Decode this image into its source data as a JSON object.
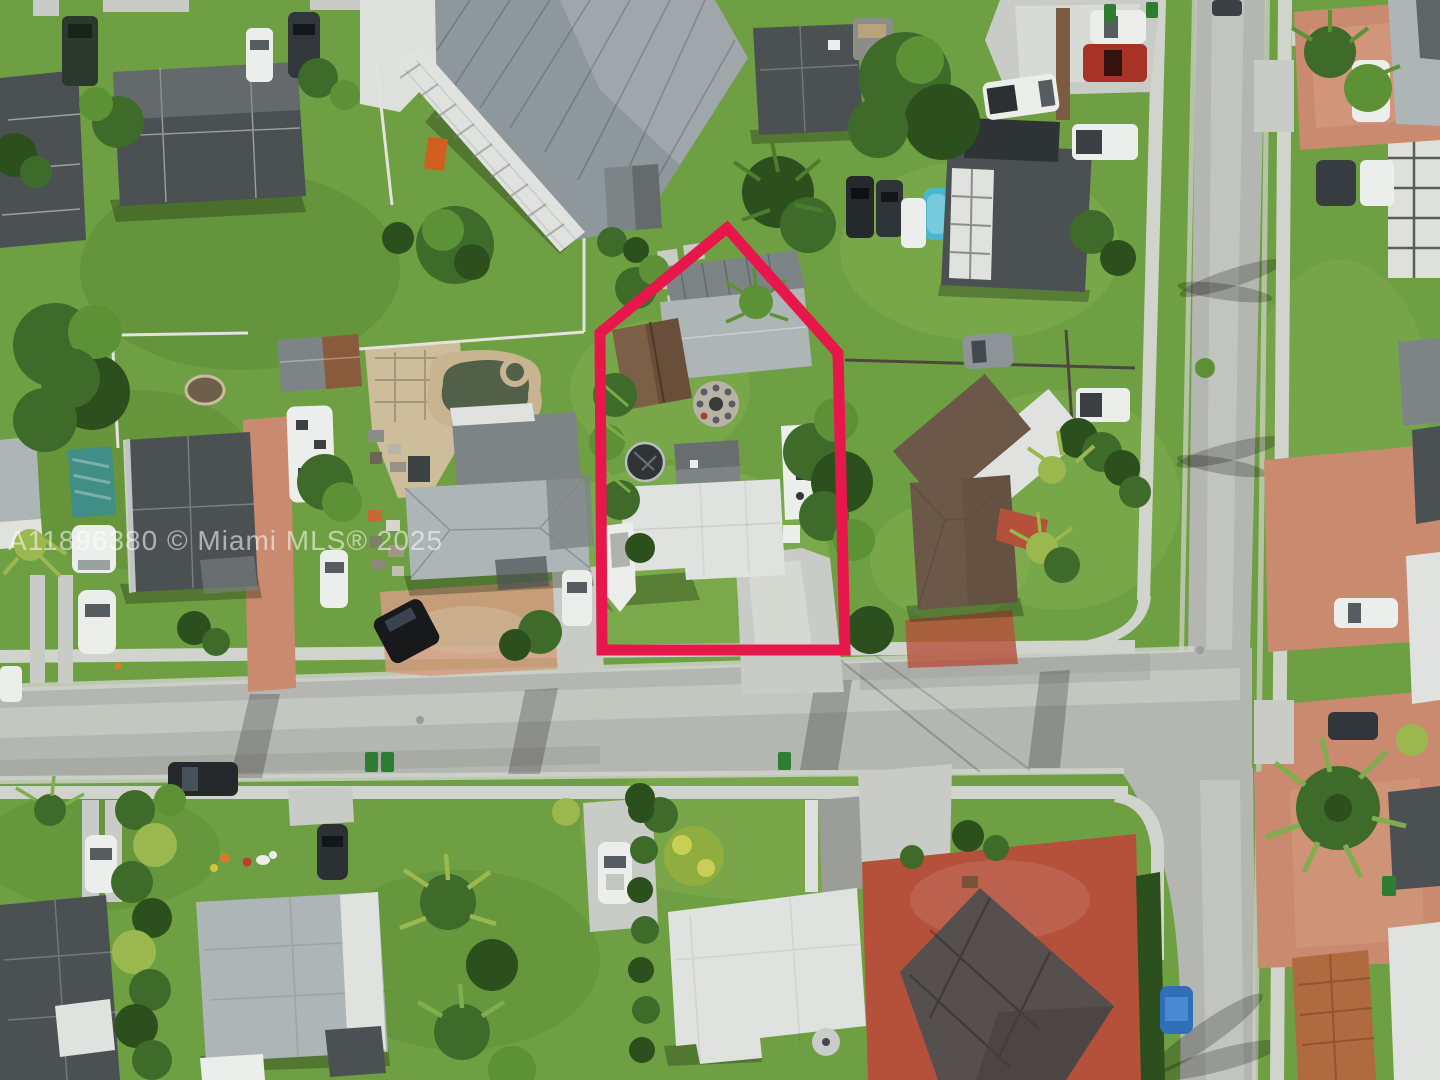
{
  "scene": {
    "description": "Aerial drone photo of a suburban residential neighborhood with a property highlighted by a red boundary outline",
    "subject_property": "house with white roof, carport, brown-roof section, fire pit, RV, boat and driveway inside red outline",
    "roads": "T-intersection: street running west-east meeting a north-south street on the right side"
  },
  "watermark": {
    "text": "A11896380 © Miami MLS® 2025",
    "color": "#ffffff",
    "opacity": 0.55
  },
  "property_outline": {
    "points": "727,228 838,353 845,650 602,650 600,333",
    "color": "#e8174b",
    "stroke_width": 11
  },
  "palette": {
    "grass": "#6f9f43",
    "grass_light": "#82b052",
    "grass_dark": "#558530",
    "road": "#b4b7b1",
    "road_worn": "#c7cac4",
    "road_dark": "#9b9e98",
    "sidewalk": "#d1d4cd",
    "concrete": "#c9ccc6",
    "concrete_bright": "#dee1db",
    "paver": "#c98a6f",
    "paver_light": "#d69c82",
    "court": "#b5503a",
    "roof_dark": "#4b5153",
    "roof_mid": "#7d8486",
    "roof_light": "#aeb5b7",
    "roof_white": "#dfe2df",
    "roof_metal": "#8e989c",
    "roof_brown": "#6b5848",
    "roof_shingle": "#7b5f46",
    "roof_orange": "#b06a3f",
    "tree": "#3e6b2a",
    "tree_light": "#5d9136",
    "tree_dark": "#2c501d",
    "tree_yellow": "#9ab84e",
    "water": "#52604a",
    "stone": "#c9b492",
    "sand": "#cdbd9b",
    "pool": "#49b8cf",
    "teal": "#3f8f86",
    "white": "#eceeeb",
    "red": "#e8174b",
    "bin": "#2e7d32"
  }
}
